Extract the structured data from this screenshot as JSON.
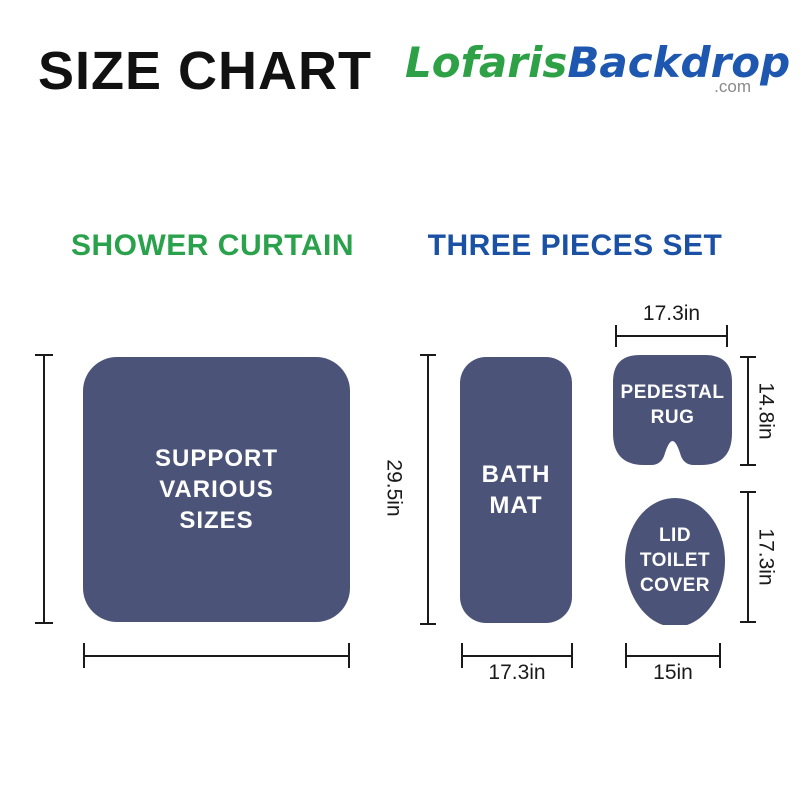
{
  "header": {
    "title": "SIZE CHART",
    "logo": {
      "brand_green": "Lofaris",
      "brand_blue": "Backdrop",
      "domain_suffix": ".com"
    }
  },
  "sections": {
    "shower_curtain_heading": "SHOWER CURTAIN",
    "three_pieces_heading": "THREE PIECES SET"
  },
  "shower_curtain": {
    "label_lines": [
      "SUPPORT",
      "VARIOUS",
      "SIZES"
    ]
  },
  "bath_mat": {
    "label_lines": [
      "BATH",
      "MAT"
    ],
    "height": "29.5in",
    "width": "17.3in"
  },
  "pedestal_rug": {
    "label_lines": [
      "PEDESTAL",
      "RUG"
    ],
    "width": "17.3in",
    "height": "14.8in"
  },
  "lid_toilet_cover": {
    "label_lines": [
      "LID",
      "TOILET",
      "COVER"
    ],
    "height": "17.3in",
    "width": "15in"
  },
  "colors": {
    "shape_fill": "#4B5478",
    "heading_green": "#2AA24C",
    "heading_blue": "#1B51A5",
    "logo_green": "#2EA147",
    "logo_blue": "#1D57B0",
    "com_gray": "#8A8A8A",
    "line_color": "#1A1A1A",
    "title_color": "#111111",
    "shape_label_color": "#FFFFFF"
  }
}
